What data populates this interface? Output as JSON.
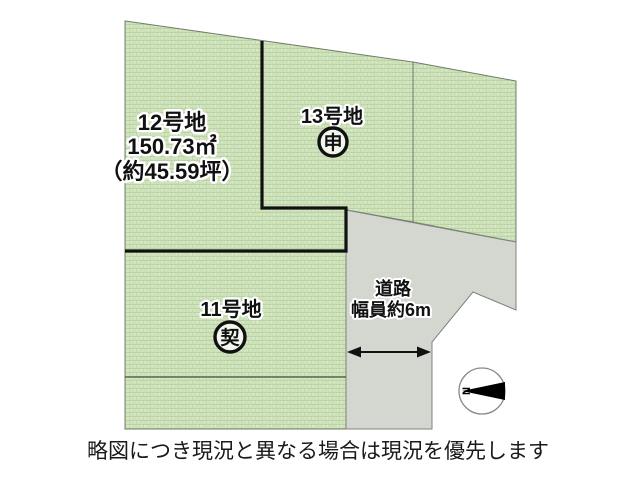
{
  "diagram": {
    "parcels": {
      "lot12": {
        "name": "12号地",
        "area_m2": "150.73㎡",
        "area_tsubo": "（約45.59坪）"
      },
      "lot13": {
        "name": "13号地",
        "status_mark": "申"
      },
      "lot11": {
        "name": "11号地",
        "status_mark": "契"
      }
    },
    "road": {
      "label_line1": "道路",
      "label_line2": "幅員約6m"
    },
    "compass": {
      "north_letter": "N"
    }
  },
  "caption": "略図につき現況と異なる場合は現況を優先します",
  "colors": {
    "parcel_green": "#cde2b8",
    "parcel_grid": "#b3cc9f",
    "road_gray": "#d4d7d0",
    "boundary_black": "#111111"
  }
}
